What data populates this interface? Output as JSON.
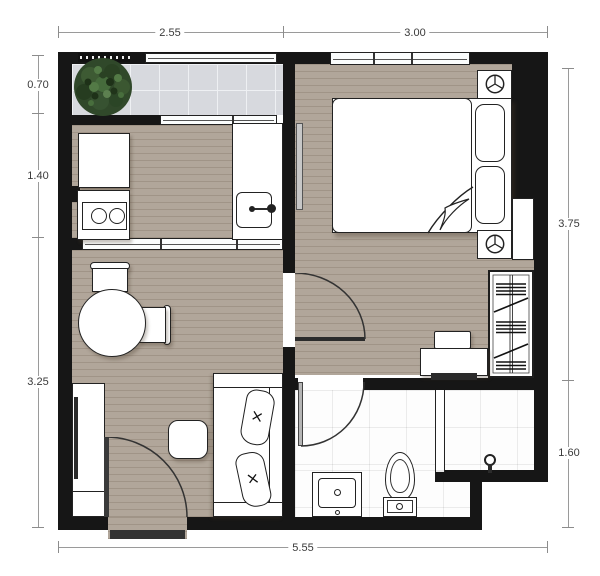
{
  "title": "one-bedroom-unit-floor-plan",
  "dimensions": {
    "unit": "m",
    "top": [
      {
        "label": "2.55"
      },
      {
        "label": "3.00"
      }
    ],
    "left": [
      {
        "label": "0.70"
      },
      {
        "label": "1.40"
      },
      {
        "label": "3.25"
      }
    ],
    "right": [
      {
        "label": "3.75"
      },
      {
        "label": "1.60"
      }
    ],
    "bottom": [
      {
        "label": "5.55"
      }
    ]
  },
  "colors": {
    "wall": "#161616",
    "wood_floor": "#b1a69a",
    "balcony_tile": "#d7d9de",
    "bathroom_tile": "#fdfdfd",
    "plant_green": "#30482a",
    "dimension_line": "#9a9a9a",
    "dimension_text": "#3a3a3a"
  },
  "icons": {
    "plant": "tree-canopy-circle",
    "bedside_lamp": "circle-with-three-spokes",
    "shower_valve": "circle-on-stem",
    "stove": "two-burner-circles"
  }
}
